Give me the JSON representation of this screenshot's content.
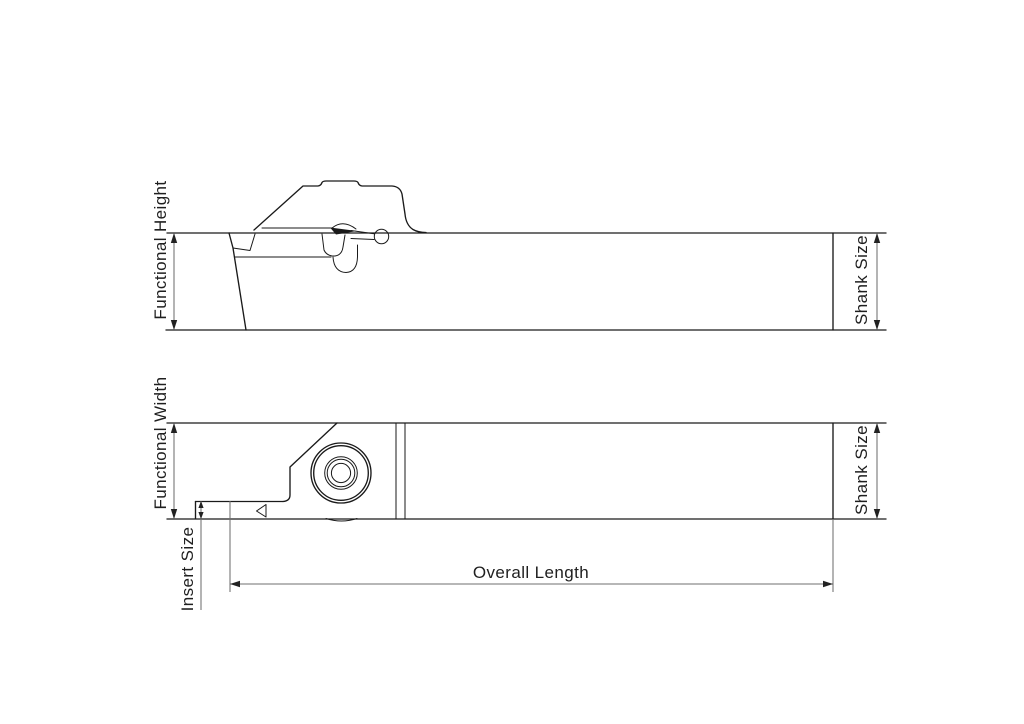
{
  "diagram": {
    "side_view": {
      "functional_height_label": "Functional Height",
      "shank_size_label": "Shank Size"
    },
    "top_view": {
      "functional_width_label": "Functional Width",
      "insert_size_label": "Insert Size",
      "shank_size_label": "Shank Size",
      "overall_length_label": "Overall Length"
    },
    "colors": {
      "background": "#ffffff",
      "drawing_line": "#1a1a1a",
      "dimension_line": "#6f6f6f",
      "text": "#1f1f1f"
    }
  }
}
